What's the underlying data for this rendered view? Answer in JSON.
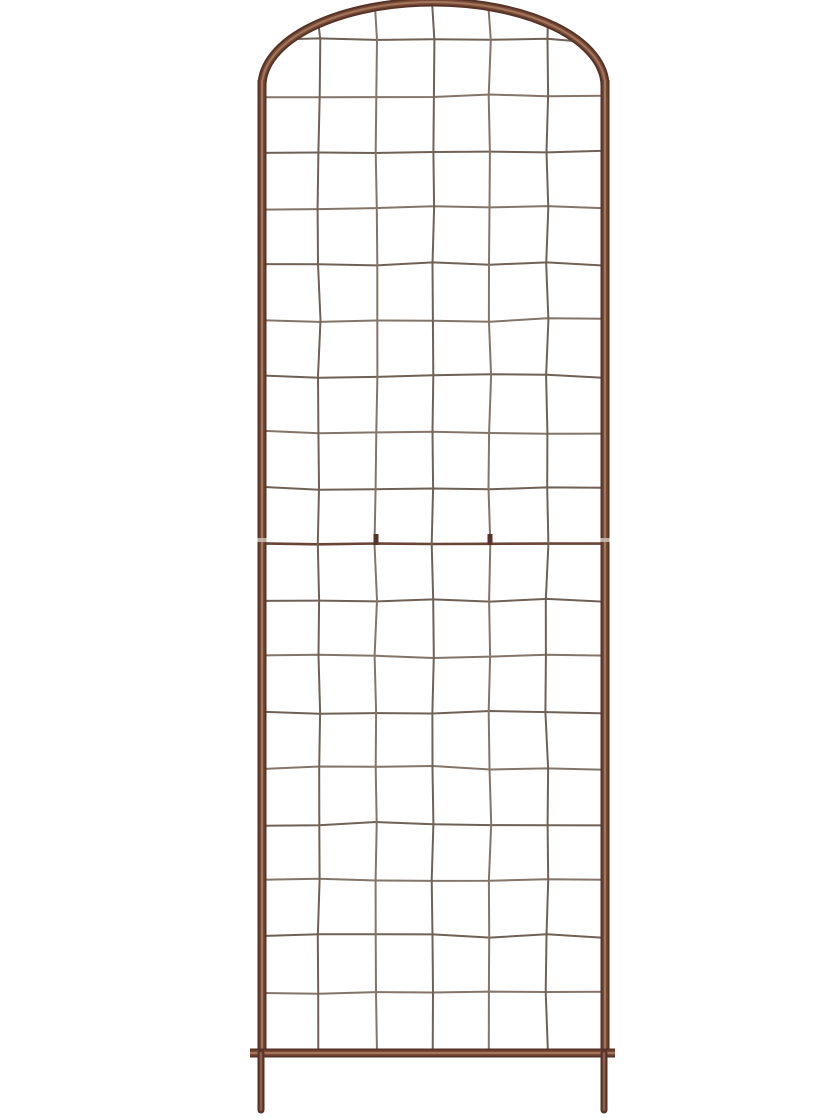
{
  "scene": {
    "description": "Product photograph of a tall rustic metal garden trellis with an arched top and square wire grid, standing on two ground stakes, on a plain white background",
    "object": "arched-metal-garden-trellis",
    "background_color": "#ffffff"
  },
  "colors": {
    "background": "#ffffff",
    "frame_dark": "#553327",
    "frame_mid": "#7b4b38",
    "frame_light": "#a1765a",
    "wire_dark": "#6f6156",
    "wire_light": "#84756a",
    "joint_wire": "#6a4437",
    "clip": "#59332a",
    "joint_band": "#cfbfb2"
  },
  "geometry": {
    "canvas": {
      "width": 840,
      "height": 1120
    },
    "frame": {
      "center_x": 433.5,
      "arch_rx": 171.5,
      "arch_ry": 84,
      "arch_center_y": 86,
      "left_rail_x": 262,
      "right_rail_x": 605,
      "rail_top_y": 80,
      "rail_bottom_y": 1054,
      "bottom_bar_y": 1053,
      "bottom_bar_x1": 250,
      "bottom_bar_x2": 615,
      "frame_width": 9,
      "stake_width": 7,
      "stake_left_x": 261,
      "stake_right_x": 604,
      "stake_top_y": 1053,
      "stake_bottom_y": 1110
    },
    "grid": {
      "vertical_wires_x": [
        319,
        376,
        433,
        490,
        547
      ],
      "horizontal_first_y": 40,
      "horizontal_spacing": 56,
      "horizontal_count": 18,
      "joint_row_index": 9,
      "joint_clip_xs": [
        376,
        490
      ],
      "joint_band_y": 538,
      "wire_width": 2,
      "joint_wire_width": 2.6,
      "wire_wiggle": 2
    }
  }
}
